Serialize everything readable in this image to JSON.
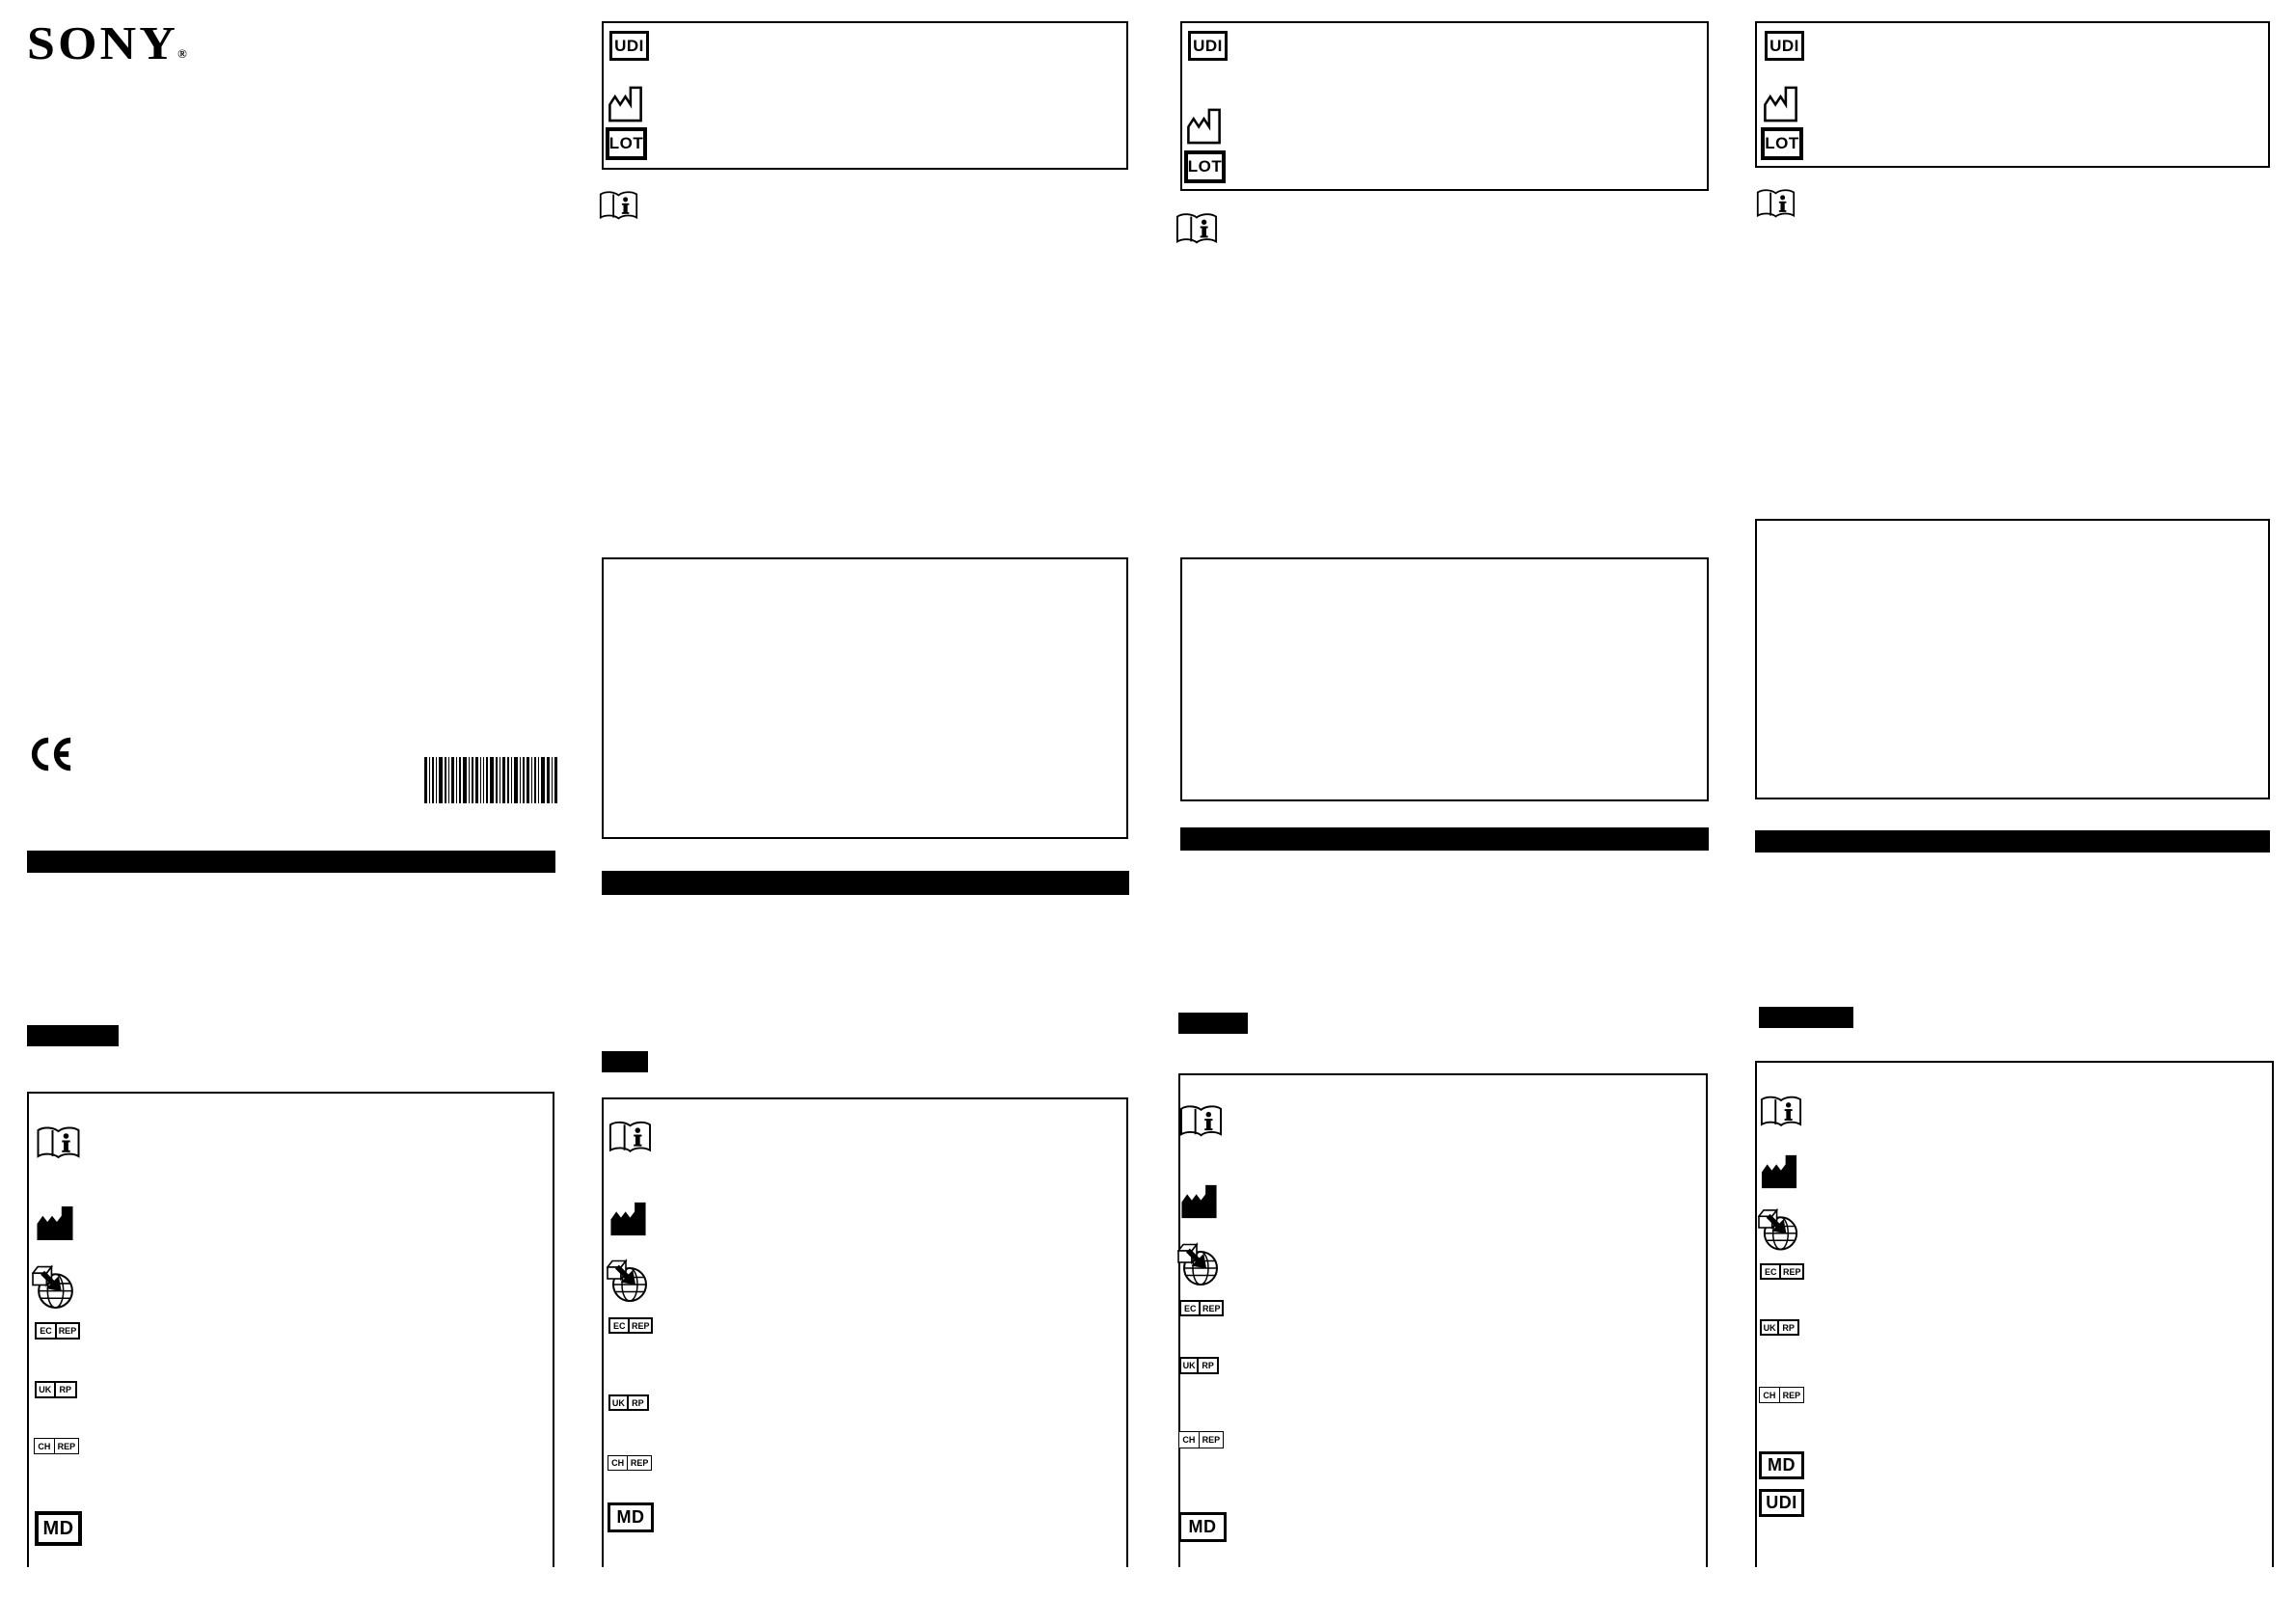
{
  "page": {
    "kind": "printed-leaflet-scan",
    "background_color": "#ffffff",
    "ink_color": "#000000",
    "panel_count": 4
  },
  "brand": {
    "name": "SONY",
    "reg": "®"
  },
  "symbols": {
    "udi": {
      "label": "UDI",
      "meaning": "unique-device-identifier"
    },
    "lot": {
      "label": "LOT",
      "meaning": "batch-code"
    },
    "md": {
      "label": "MD",
      "meaning": "medical-device"
    },
    "ec_rep": {
      "left": "EC",
      "right": "REP",
      "meaning": "authorised-representative-in-the-european-community"
    },
    "uk_rp": {
      "left": "UK",
      "right": "RP",
      "meaning": "uk-responsible-person"
    },
    "ch_rep": {
      "left": "CH",
      "right": "REP",
      "meaning": "swiss-authorised-representative"
    },
    "consult_ifu": {
      "meaning": "consult-instructions-for-use"
    },
    "manufacturer": {
      "meaning": "manufacturer"
    },
    "importer": {
      "meaning": "importer"
    },
    "ce": {
      "meaning": "ce-marking"
    },
    "barcode": {
      "meaning": "product-barcode"
    }
  },
  "panels": [
    {
      "name": "panel-1",
      "elements": [
        "brand-logo",
        "ce-mark",
        "barcode",
        "redacted-text-bar",
        "section-header-bar",
        "symbols-box"
      ],
      "symbols_box": [
        "consult-ifu",
        "manufacturer",
        "importer",
        "ec-rep",
        "uk-rp",
        "ch-rep",
        "md"
      ]
    },
    {
      "name": "panel-2",
      "top_label_box": [
        "udi",
        "manufacturer",
        "lot"
      ],
      "elements": [
        "consult-ifu",
        "empty-content-box",
        "redacted-text-bar",
        "section-header-bar",
        "symbols-box"
      ],
      "symbols_box": [
        "consult-ifu",
        "manufacturer",
        "importer",
        "ec-rep",
        "uk-rp",
        "ch-rep",
        "md"
      ]
    },
    {
      "name": "panel-3",
      "top_label_box": [
        "udi",
        "manufacturer",
        "lot"
      ],
      "elements": [
        "consult-ifu",
        "empty-content-box",
        "redacted-text-bar",
        "section-header-bar",
        "symbols-box"
      ],
      "symbols_box": [
        "consult-ifu",
        "manufacturer",
        "importer",
        "ec-rep",
        "uk-rp",
        "ch-rep",
        "md"
      ]
    },
    {
      "name": "panel-4",
      "top_label_box": [
        "udi",
        "manufacturer",
        "lot"
      ],
      "elements": [
        "consult-ifu",
        "empty-content-box",
        "redacted-text-bar",
        "section-header-bar",
        "symbols-box"
      ],
      "symbols_box": [
        "consult-ifu",
        "manufacturer",
        "importer",
        "ec-rep",
        "uk-rp",
        "ch-rep",
        "md",
        "udi"
      ]
    }
  ]
}
